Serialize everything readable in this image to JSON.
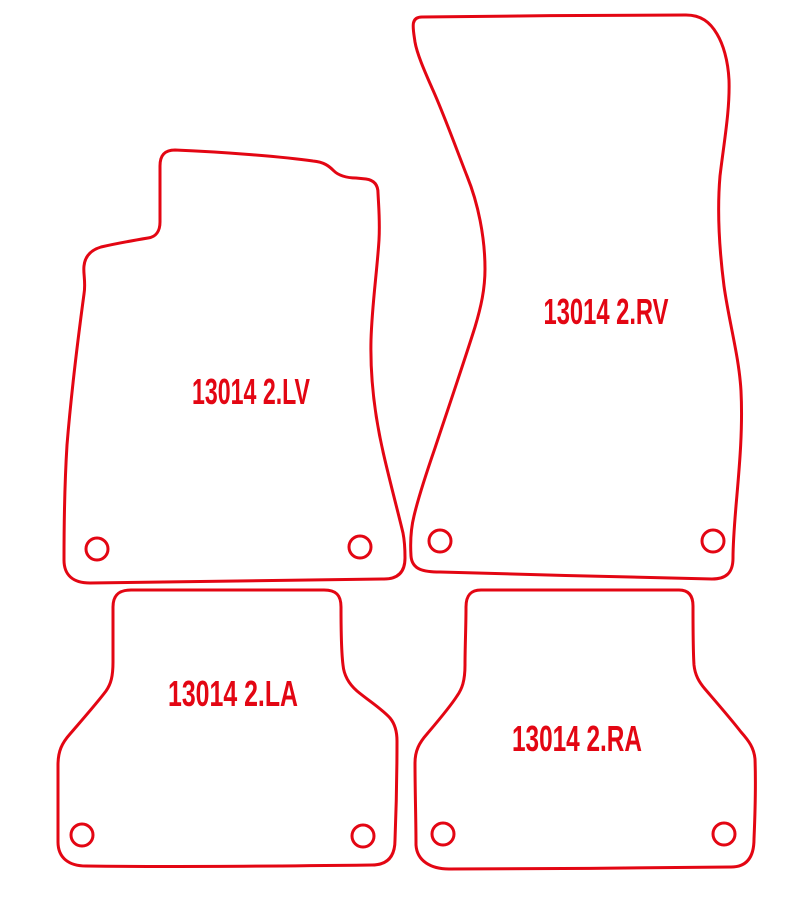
{
  "drawing": {
    "background": "#ffffff",
    "outline_color": "#e30613",
    "stroke_width": 3,
    "mats": [
      {
        "name": "front-left",
        "position": "top-left",
        "label": "13014 2.LV",
        "fixing_holes": 2
      },
      {
        "name": "front-right",
        "position": "top-right",
        "label": "13014 2.RV",
        "fixing_holes": 2
      },
      {
        "name": "rear-left",
        "position": "bottom-left",
        "label": "13014 2.LA",
        "fixing_holes": 2
      },
      {
        "name": "rear-right",
        "position": "bottom-right",
        "label": "13014 2.RA",
        "fixing_holes": 2
      }
    ]
  }
}
